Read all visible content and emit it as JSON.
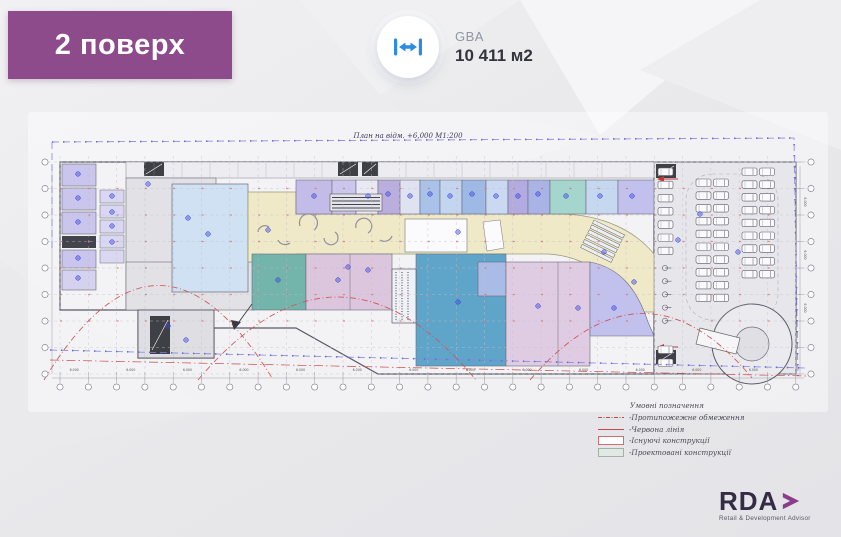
{
  "slide": {
    "floor_badge": "2 поверх"
  },
  "gba": {
    "label": "GBA",
    "value": "10 411 м2",
    "icon": "width-arrows-icon"
  },
  "plan": {
    "title": "План на відм. +6,000   М1:200",
    "dim_label": "6.000"
  },
  "legend": {
    "title": "Умовні позначення",
    "items": [
      {
        "label": "-Протипожежне обмеження",
        "swatch": "red-dashdot-line"
      },
      {
        "label": "-Червона лінія",
        "swatch": "red-solid-line"
      },
      {
        "label": "-Існуючі конструкції",
        "swatch": "red-outline-rect"
      },
      {
        "label": "-Проектовані конструкції",
        "swatch": "green-fill-rect"
      }
    ]
  },
  "logo": {
    "name": "RDA",
    "tagline": "Retail & Development Advisor"
  },
  "colors": {
    "badge_purple": "#8d4b8c",
    "icon_blue": "#2b8ce0",
    "logo_purple": "#8a3d8a",
    "logo_text": "#342c45",
    "red_line": "#c84848",
    "boundary_purple": "#8585dc",
    "corridor_yellow": "#efe9c8",
    "unit_lavender": "#c3bce8",
    "unit_light_blue": "#cfe1f3",
    "unit_blue": "#5fa5c9",
    "unit_teal": "#74b5ab",
    "unit_pink": "#dcc6de"
  }
}
